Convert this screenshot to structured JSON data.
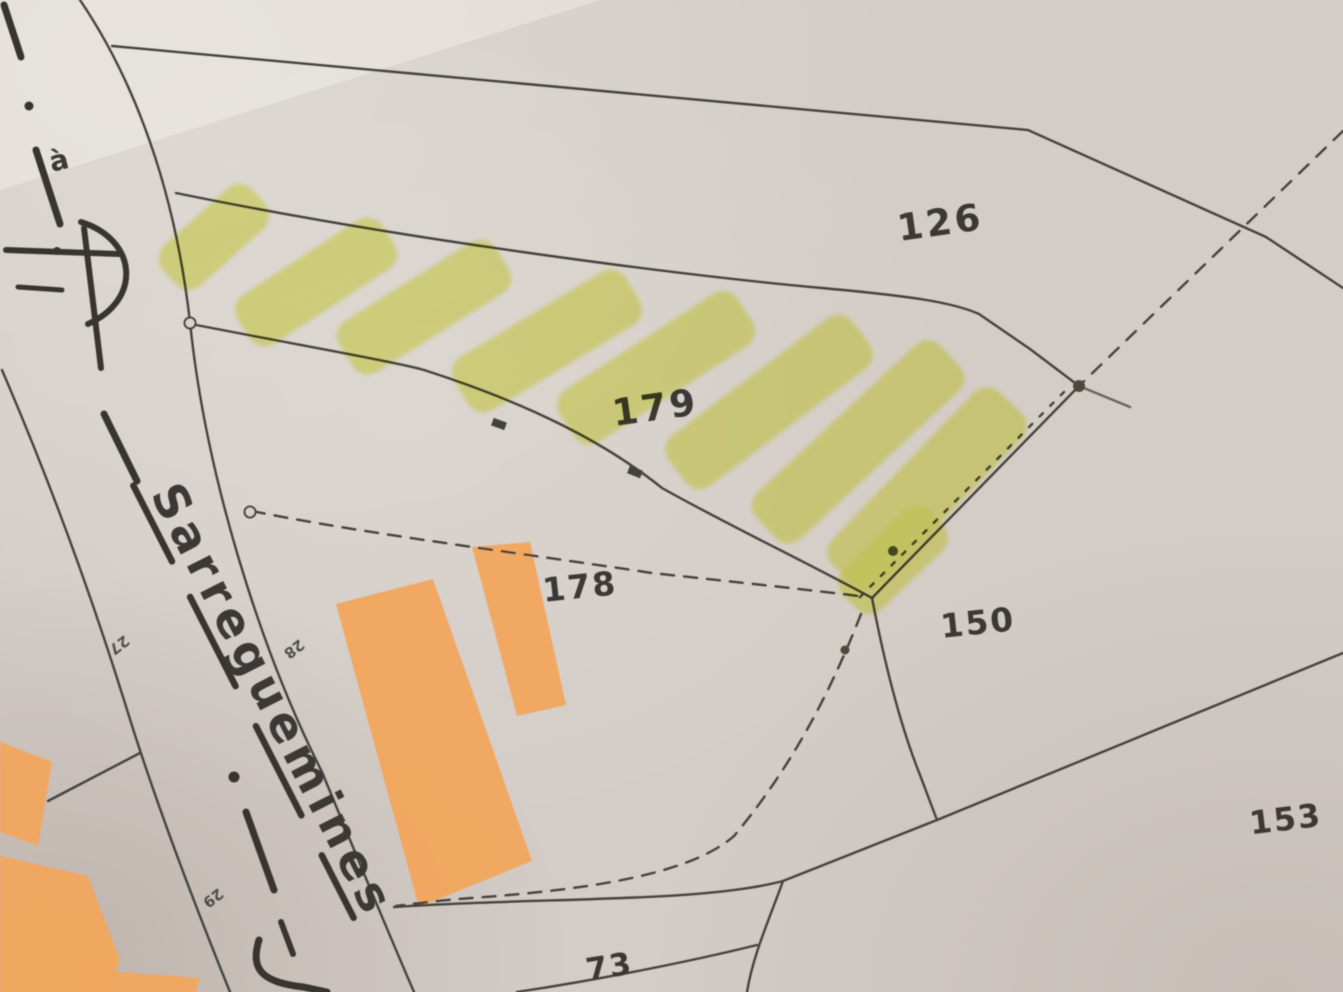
{
  "map": {
    "type": "cadastral-parcel-map-photo",
    "road": {
      "name": "Sarreguemines"
    },
    "parcels": [
      {
        "id": "126",
        "label": "126",
        "highlighted": false
      },
      {
        "id": "179",
        "label": "179",
        "highlighted": true
      },
      {
        "id": "178",
        "label": "178",
        "highlighted": false
      },
      {
        "id": "150",
        "label": "150",
        "highlighted": false
      },
      {
        "id": "153",
        "label": "153",
        "highlighted": false
      },
      {
        "id": "73",
        "label": "73",
        "highlighted": false
      }
    ],
    "house_numbers": [
      "27",
      "28",
      "29"
    ],
    "annotations": [
      {
        "text": "à"
      }
    ],
    "colors": {
      "paper": "#d4cdc7",
      "boundary_line": "#45423c",
      "road_centerline": "#38362f",
      "label_text": "#3b3934",
      "building_fill": "#f2a55c",
      "highlighter": "#e7ee6d"
    }
  }
}
